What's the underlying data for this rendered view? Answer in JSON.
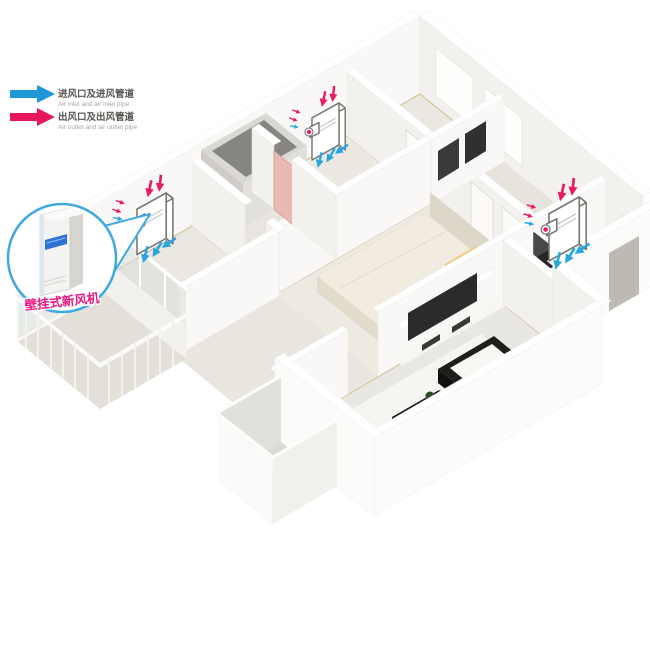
{
  "legend": {
    "items": [
      {
        "zh": "进风口及进风管道",
        "en": "Air inlet and air inlet pipe",
        "color": "#1f96d6",
        "icon": "right-arrow"
      },
      {
        "zh": "出风口及出风管道",
        "en": "Air outlet and air outlet pipe",
        "color": "#e8175d",
        "icon": "right-arrow"
      }
    ]
  },
  "callout": {
    "label": "壁挂式新风机",
    "label_color": "#ef1480",
    "circle_color": "#3fa9e0"
  },
  "units": {
    "count": 3,
    "inlet_arrow_color": "#ec1a66",
    "outlet_arrow_color": "#29a6de"
  }
}
